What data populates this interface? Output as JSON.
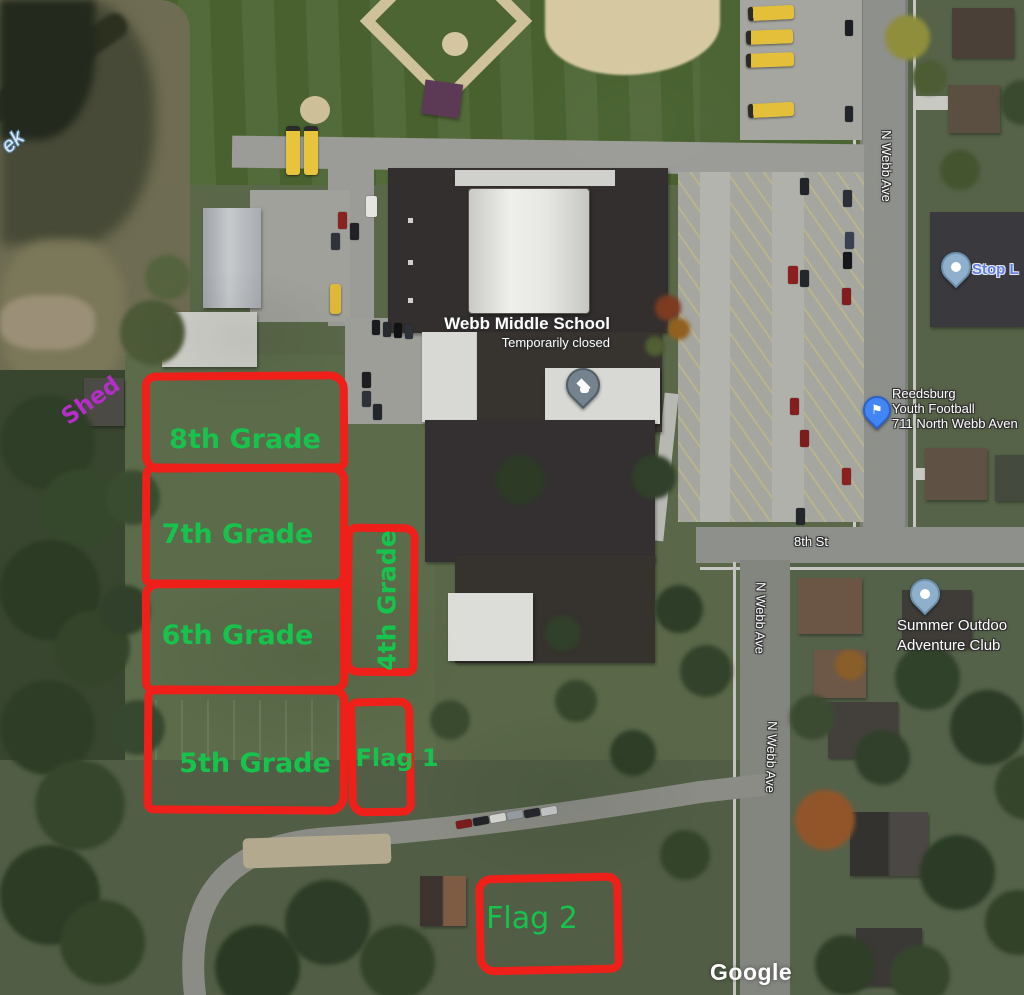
{
  "map_overlay": {
    "school": {
      "name": "Webb Middle School",
      "status": "Temporarily closed"
    },
    "pois": {
      "stop": {
        "label": "Stop L"
      },
      "football": {
        "lines": [
          "Reedsburg",
          "Youth Football",
          "711 North Webb Aven"
        ]
      },
      "adventure": {
        "lines": [
          "Summer Outdoo",
          "Adventure Club"
        ]
      }
    },
    "road_labels": {
      "n_webb_top": "N Webb Ave",
      "n_webb_mid": "N Webb Ave",
      "n_webb_bottom": "N Webb Ave",
      "eighth_st": "8th St",
      "creek_fragment": "ek"
    },
    "attribution": "Google"
  },
  "annotations": {
    "zones": [
      {
        "label": "8th Grade"
      },
      {
        "label": "7th Grade"
      },
      {
        "label": "6th Grade"
      },
      {
        "label": "5th Grade"
      },
      {
        "label": "4th Grade"
      },
      {
        "label": "Flag 1"
      },
      {
        "label": "Flag 2"
      }
    ],
    "shed_label": "Shed"
  },
  "colors": {
    "annotation_red": "#ef1f1a",
    "annotation_green": "#16c34c",
    "shed_purple": "#b52ec9",
    "poi_pin_blue": "#4285f4",
    "poi_pin_lightblue": "#8fb0cd",
    "school_pin_gray": "#74838d",
    "stop_text_blue": "#5f7ce0"
  }
}
